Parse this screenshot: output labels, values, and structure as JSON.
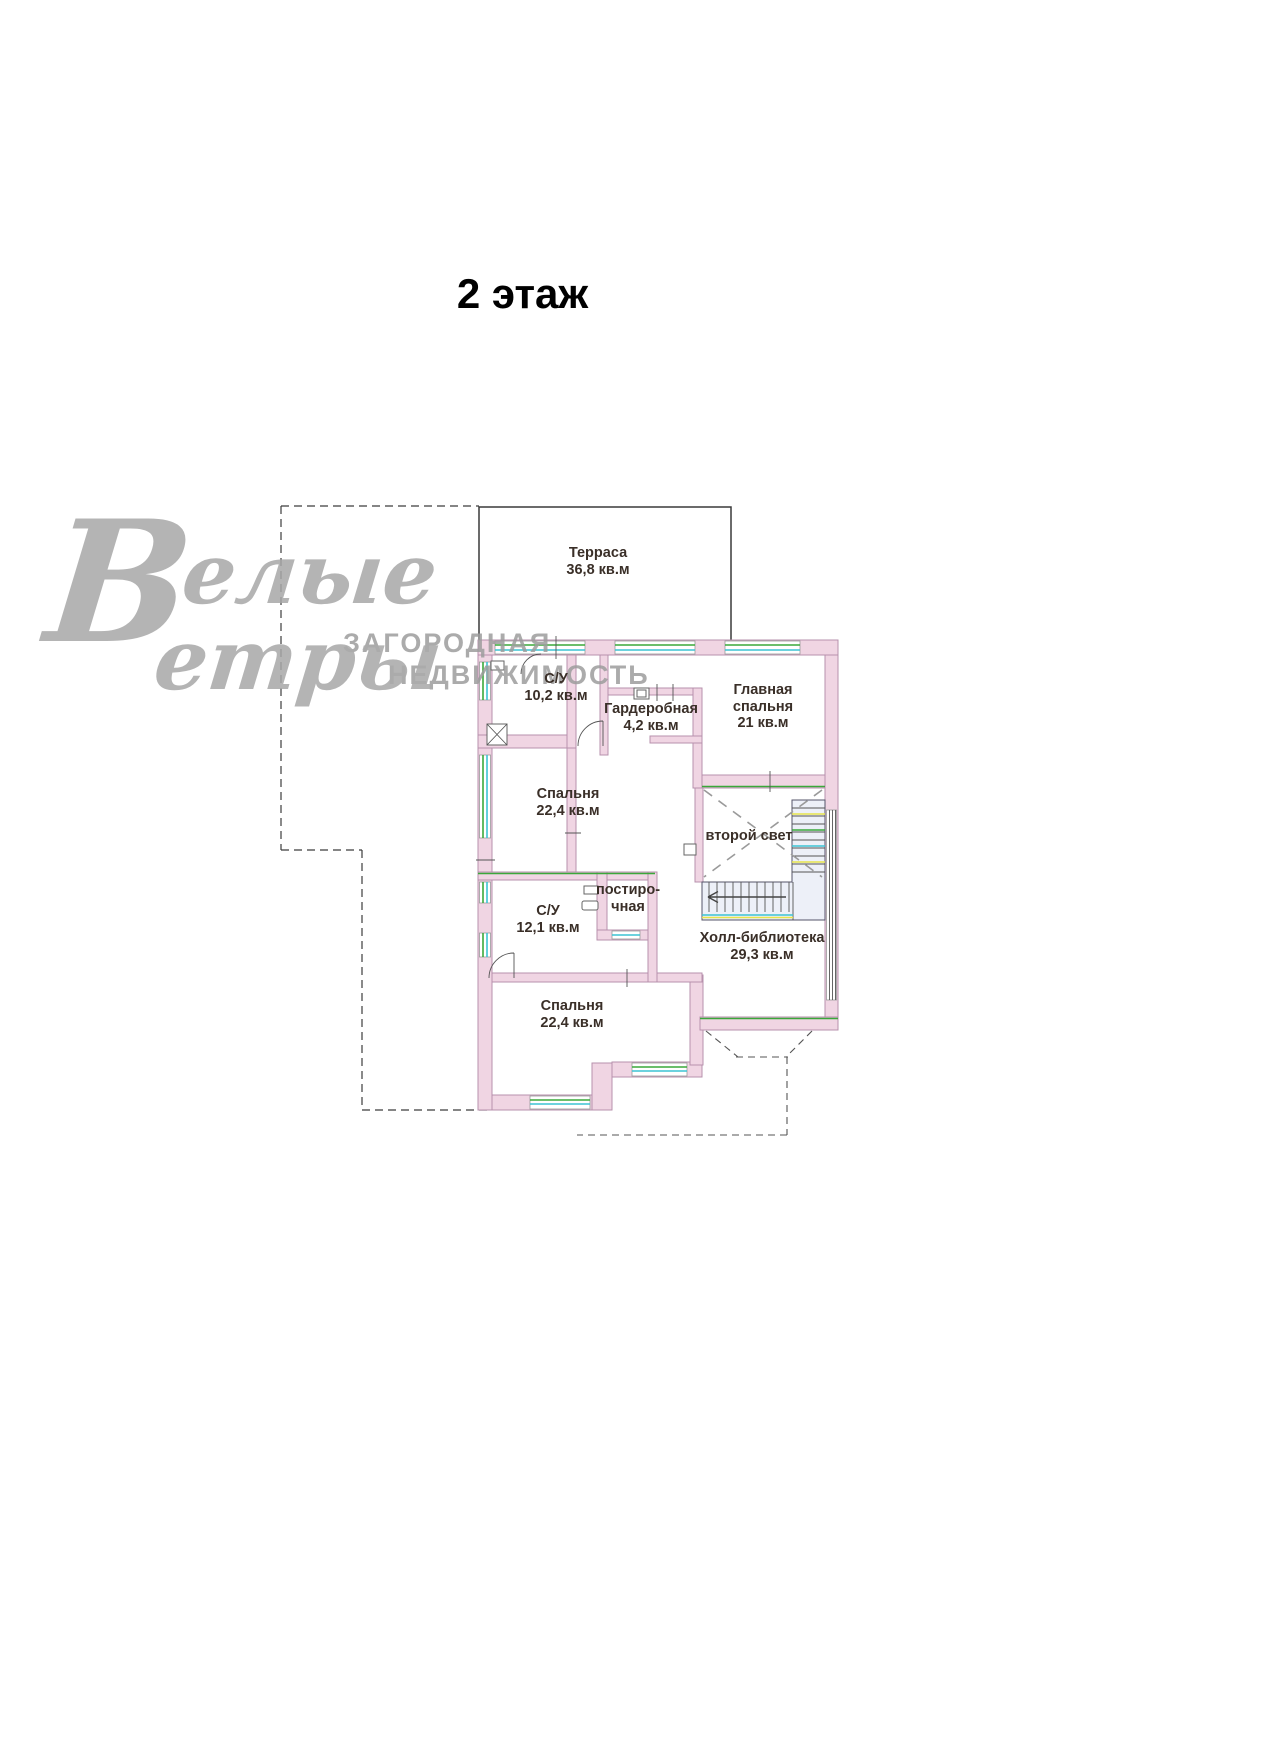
{
  "title": "2 этаж",
  "watermark": {
    "big_letter": "В",
    "word1_rest": "елые",
    "word2_rest": "етры",
    "tagline1": "ЗАГОРОДНАЯ",
    "tagline2": "НЕДВИЖИМОСТЬ"
  },
  "floor_plan": {
    "rooms": [
      {
        "name": "Терраса",
        "area": "36,8 кв.м"
      },
      {
        "name": "С/У",
        "area": "10,2 кв.м"
      },
      {
        "name": "Гардеробная",
        "area": "4,2 кв.м"
      },
      {
        "name": "Главная",
        "name2": "спальня",
        "area": "21 кв.м"
      },
      {
        "name": "Спальня",
        "area": "22,4 кв.м"
      },
      {
        "name": "второй свет",
        "area": ""
      },
      {
        "name": "постиро-",
        "name2": "чная",
        "area": ""
      },
      {
        "name": "С/У",
        "area": "12,1 кв.м"
      },
      {
        "name": "Холл-библиотека",
        "area": "29,3 кв.м"
      },
      {
        "name": "Спальня",
        "area": "22,4 кв.м"
      }
    ],
    "colors": {
      "wall_fill": "#f0d5e3",
      "wall_stroke": "#b791ad",
      "window_green": "#3aa83a",
      "window_cyan": "#3cc3d4",
      "accent_yellow": "#e6e44a"
    }
  }
}
